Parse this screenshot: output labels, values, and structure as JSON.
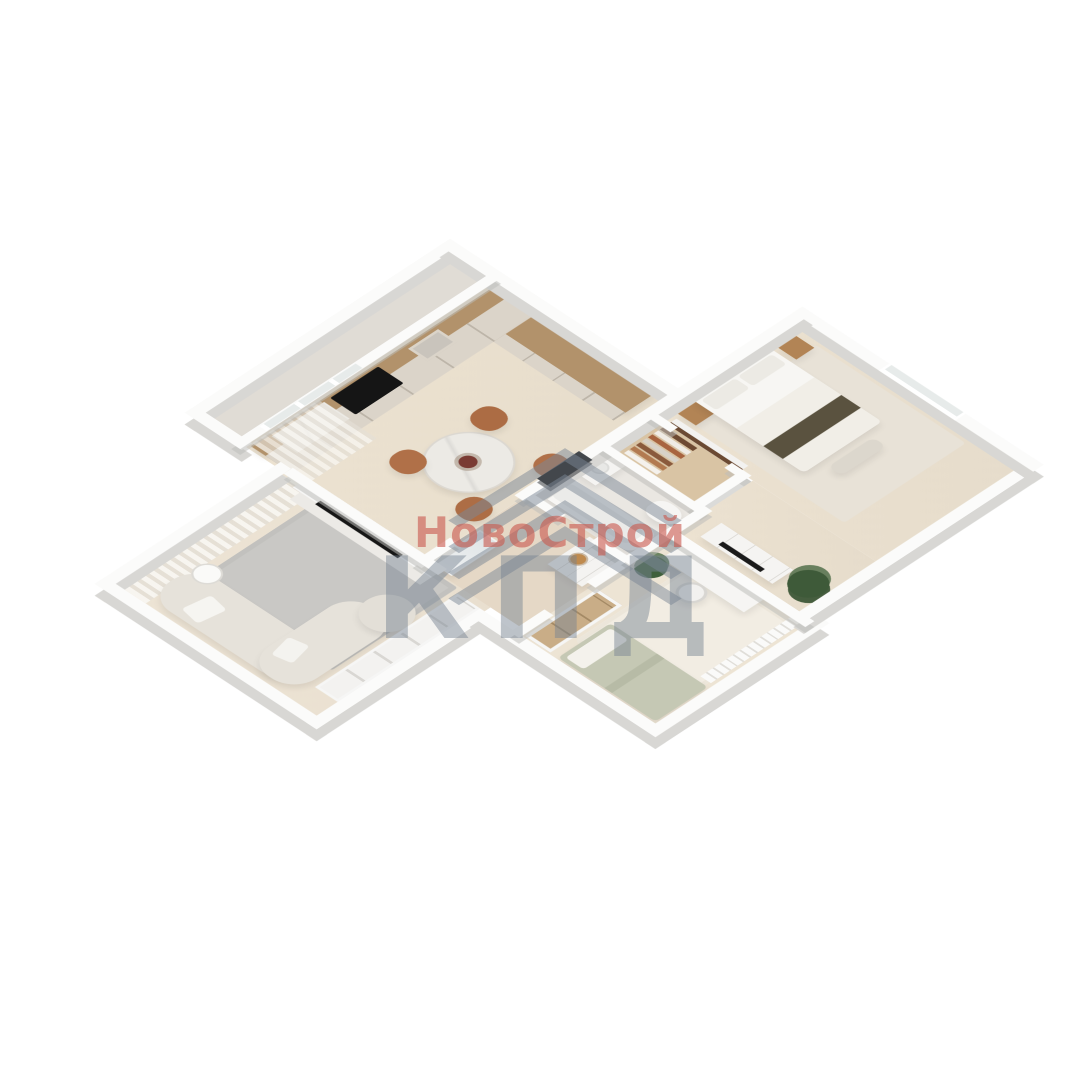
{
  "watermark": {
    "logo_icon": "roof-chevron-icon",
    "brand": "НовоСтрой",
    "acronym": "КПД",
    "brand_color": "rgba(201,90,80,0.62)",
    "mark_color": "rgba(120,132,146,0.48)"
  },
  "palette": {
    "background": "#ffffff",
    "floor_wood_light": "#ebe1d0",
    "hall_floor": "#e5d8c6",
    "wall_top": "#fbfbfa",
    "wall_side": "#d8d7d4",
    "rug_gray": "#c9c8c5",
    "rug_cream": "#f2ede3",
    "counter_wood": "#b2926b",
    "cabinet_front": "#dbd4c9",
    "marble": "#eceae5",
    "sofa_boucle": "#e6e2da",
    "dining_chair": "#b07048",
    "cooktop_black": "#151515",
    "entry_door": "#43474c",
    "bed_runner_olive": "#5a523f",
    "kids_bed_sage": "#c5c8b4",
    "wardrobe_walnut": "#6b4a33",
    "plant_green": "#3e5a39",
    "gold_tray": "#bf8a4e",
    "glazing": "#e7ebea",
    "closet_wood": "#c9ad87"
  },
  "rooms": [
    "balcony",
    "kitchen-dining",
    "living-room",
    "hallway",
    "bathroom",
    "walk-in-closet",
    "bedroom",
    "kids-room"
  ]
}
